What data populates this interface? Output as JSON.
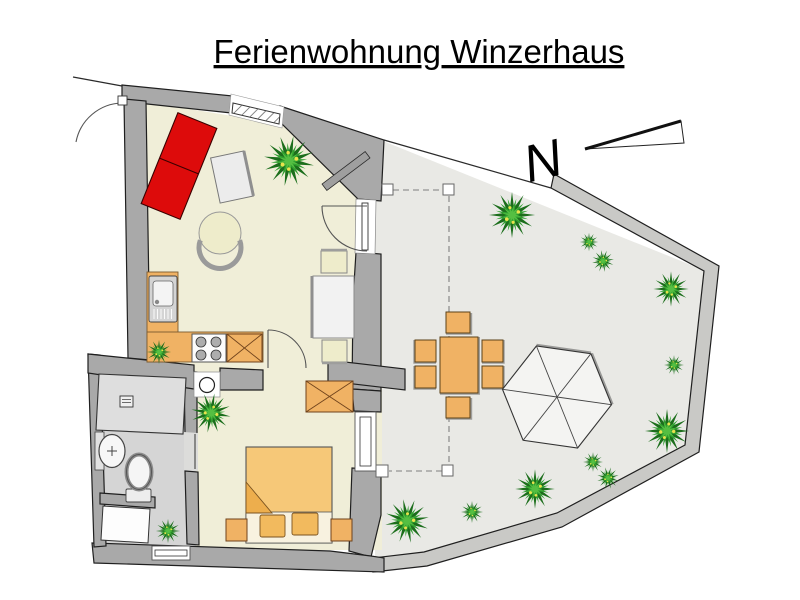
{
  "title": "Ferienwohnung Winzerhaus",
  "compass": {
    "label": "N"
  },
  "colors": {
    "wall": "#a9a9a9",
    "living_floor": "#f0eed8",
    "bathroom_floor": "#d5d5d5",
    "terrace_floor": "#e9e9e5",
    "terrace_wall": "#c9c9c6",
    "sofa": "#dd0b0b",
    "wood": "#f0b264",
    "bed": "#f6c878",
    "bed_fold": "#edae4d",
    "pillow": "#f2ba5e",
    "bed_sheet": "#f8f2e0",
    "chair_pale": "#eeeccb",
    "table_white": "#f2f2f2",
    "coffee_table": "#ececec",
    "umbrella": "#f4f4f2",
    "shower": "#dedede",
    "plant_dark": "#1c6e1c",
    "plant_mid": "#2fa02f",
    "plant_light": "#55bf42",
    "plant_dot": "#e8e24c"
  }
}
